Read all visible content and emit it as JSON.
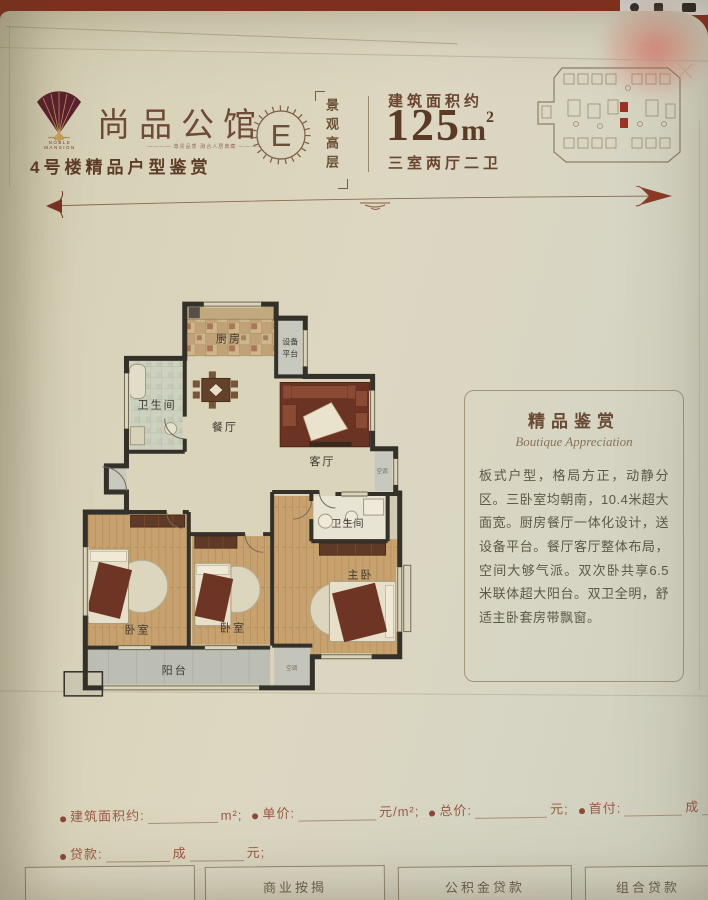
{
  "header": {
    "brand": {
      "name": "尚品公馆",
      "latin1": "NOBLE",
      "latin2": "MANSION",
      "tagline": "尊贵品质·融合人居典藏",
      "series": "4号楼精品户型鉴赏"
    },
    "badge": {
      "letter": "E",
      "tag_vertical": "景观高层"
    },
    "area": {
      "label": "建筑面积约",
      "value": "125",
      "unit": "m",
      "sup": "2",
      "rooms": "三室两厅二卫"
    }
  },
  "floorplan": {
    "rooms": {
      "kitchen": "厨房",
      "equipment1": "设备",
      "equipment2": "平台",
      "bath_top": "卫生间",
      "dining": "餐厅",
      "living": "客厅",
      "bath_right": "卫生间",
      "bedroom_left": "卧室",
      "bedroom_mid": "卧室",
      "master": "主卧",
      "balcony": "阳台",
      "ac1": "空调",
      "ac2": "空调"
    }
  },
  "panel": {
    "title": "精品鉴赏",
    "subtitle": "Boutique Appreciation",
    "body": "板式户型，格局方正，动静分区。三卧室均朝南，10.4米超大面宽。厨房餐厅一体化设计，送设备平台。餐厅客厅整体布局，空间大够气派。双次卧共享6.5米联体超大阳台。双卫全明，舒适主卧套房带飘窗。"
  },
  "form": {
    "area_label": "建筑面积约:",
    "area_suffix": "m²;",
    "unit_label": "单价:",
    "unit_suffix": "元/m²;",
    "total_label": "总价:",
    "total_suffix": "元;",
    "down_label": "首付:",
    "down_suffix": "成",
    "loan_label": "贷款:",
    "loan_mid": "成",
    "loan_suffix": "元;"
  },
  "buttons": {
    "b1": "商业按揭",
    "b2": "公积金贷款",
    "b3": "组合贷款"
  },
  "colors": {
    "brand_red": "#8c2d1e",
    "keyplan_highlight": "#a03126",
    "wall": "#34312a"
  }
}
